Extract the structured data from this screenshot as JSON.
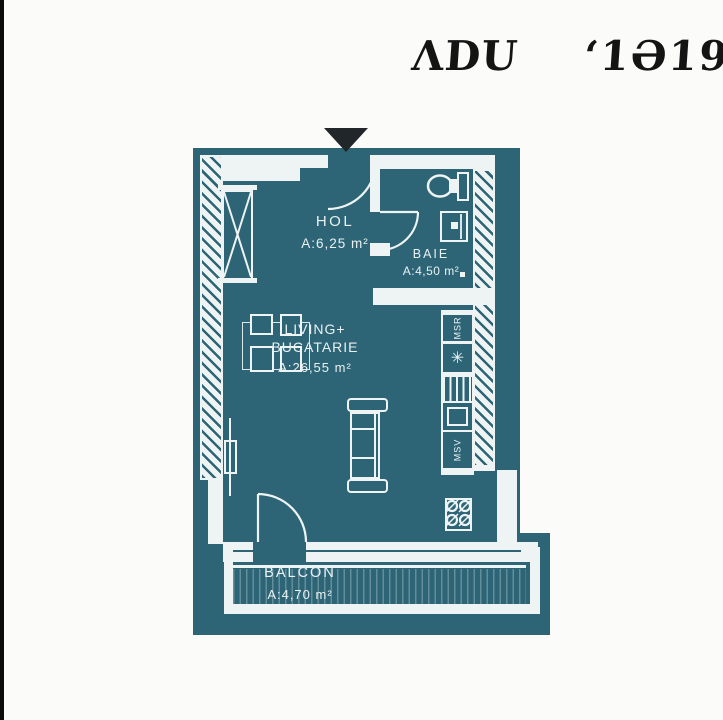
{
  "watermark": {
    "left": "ΛDU",
    "right": "‘1Ə19"
  },
  "plan": {
    "rooms": {
      "hol": {
        "name": "HOL",
        "area": "A:6,25 m²"
      },
      "baie": {
        "name": "BAIE",
        "area": "A:4,50 m²"
      },
      "living": {
        "name_line1": "LIVING+",
        "name_line2": "BUCATARIE",
        "area": "A:26,55 m²"
      },
      "balcon": {
        "name": "BALCON",
        "area": "A:4,70 m²"
      }
    },
    "appliances": {
      "washing_machine": "MSR",
      "dishwasher": "MSV",
      "boiler_icon": "✳"
    }
  },
  "colors": {
    "plan_teal": "#2d6576",
    "wall_white": "#eef4f4",
    "entrance_arrow": "#20262a",
    "watermark_text": "#141414",
    "page_background": "#fbfbfa"
  }
}
